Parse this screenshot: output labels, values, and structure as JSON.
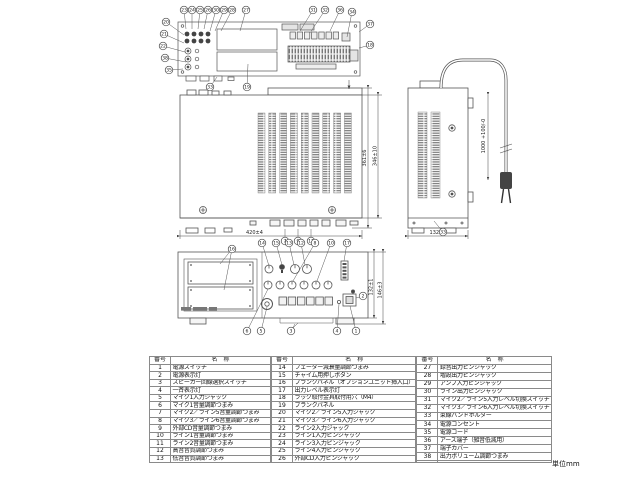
{
  "unit_label": "単位mm",
  "dims": {
    "top_width": "420±4",
    "depth_a": "361±6",
    "depth_b": "346±10",
    "side_width": "132±1",
    "cord_length": "1000 +100/-0",
    "front_height_a": "132±1",
    "front_height_b": "146±3"
  },
  "callouts": [
    {
      "n": "23",
      "x": 184,
      "y": 10,
      "lx": 186,
      "ly": 29
    },
    {
      "n": "24",
      "x": 192,
      "y": 10,
      "lx": 192,
      "ly": 29
    },
    {
      "n": "25",
      "x": 200,
      "y": 10,
      "lx": 198,
      "ly": 29
    },
    {
      "n": "26",
      "x": 208,
      "y": 10,
      "lx": 204,
      "ly": 29
    },
    {
      "n": "30",
      "x": 216,
      "y": 10,
      "lx": 210,
      "ly": 31
    },
    {
      "n": "29",
      "x": 224,
      "y": 10,
      "lx": 215,
      "ly": 31
    },
    {
      "n": "28",
      "x": 232,
      "y": 10,
      "lx": 221,
      "ly": 31
    },
    {
      "n": "27",
      "x": 246,
      "y": 10,
      "lx": 240,
      "ly": 31
    },
    {
      "n": "31",
      "x": 313,
      "y": 10,
      "lx": 300,
      "ly": 31
    },
    {
      "n": "32",
      "x": 325,
      "y": 10,
      "lx": 310,
      "ly": 33
    },
    {
      "n": "36",
      "x": 340,
      "y": 10,
      "lx": 330,
      "ly": 31
    },
    {
      "n": "34",
      "x": 352,
      "y": 12,
      "lx": 347,
      "ly": 37
    },
    {
      "n": "37",
      "x": 370,
      "y": 24,
      "lx": 359,
      "ly": 32
    },
    {
      "n": "18",
      "x": 370,
      "y": 45,
      "lx": 359,
      "ly": 48
    },
    {
      "n": "20",
      "x": 166,
      "y": 22,
      "lx": 184,
      "ly": 35
    },
    {
      "n": "21",
      "x": 164,
      "y": 34,
      "lx": 184,
      "ly": 43
    },
    {
      "n": "22",
      "x": 163,
      "y": 46,
      "lx": 185,
      "ly": 52
    },
    {
      "n": "38",
      "x": 165,
      "y": 58,
      "lx": 186,
      "ly": 62
    },
    {
      "n": "35",
      "x": 169,
      "y": 70,
      "lx": 183,
      "ly": 69
    },
    {
      "n": "33",
      "x": 210,
      "y": 87,
      "lx": 217,
      "ly": 77
    },
    {
      "n": "19",
      "x": 247,
      "y": 87,
      "lx": 248,
      "ly": 64
    },
    {
      "n": "7",
      "x": 285,
      "y": 241,
      "lx": 285,
      "ly": 229
    },
    {
      "n": "9",
      "x": 298,
      "y": 241,
      "lx": 298,
      "ly": 229
    },
    {
      "n": "11",
      "x": 311,
      "y": 241,
      "lx": 311,
      "ly": 229
    },
    {
      "n": "33",
      "x": 443,
      "y": 232,
      "lx": 434,
      "ly": 221
    },
    {
      "n": "14",
      "x": 262,
      "y": 243,
      "lx": 269,
      "ly": 266
    },
    {
      "n": "15",
      "x": 276,
      "y": 243,
      "lx": 282,
      "ly": 265
    },
    {
      "n": "13",
      "x": 289,
      "y": 243,
      "lx": 294,
      "ly": 265
    },
    {
      "n": "12",
      "x": 301,
      "y": 243,
      "lx": 305,
      "ly": 265
    },
    {
      "n": "8",
      "x": 315,
      "y": 243,
      "lx": 293,
      "ly": 281
    },
    {
      "n": "10",
      "x": 331,
      "y": 243,
      "lx": 317,
      "ly": 281
    },
    {
      "n": "17",
      "x": 347,
      "y": 243,
      "lx": 344,
      "ly": 261
    },
    {
      "n": "16",
      "x": 232,
      "y": 249,
      "lx": 220,
      "ly": 264,
      "lx2": 224,
      "ly2": 290
    },
    {
      "n": "6",
      "x": 247,
      "y": 331,
      "lx": 268,
      "ly": 289
    },
    {
      "n": "5",
      "x": 261,
      "y": 331,
      "lx": 267,
      "ly": 307
    },
    {
      "n": "3",
      "x": 291,
      "y": 331,
      "lx": 295,
      "ly": 324
    },
    {
      "n": "4",
      "x": 337,
      "y": 331,
      "lx": 339,
      "ly": 304
    },
    {
      "n": "1",
      "x": 356,
      "y": 331,
      "lx": 350,
      "ly": 306
    },
    {
      "n": "2",
      "x": 363,
      "y": 296,
      "lx": 356,
      "ly": 298
    }
  ],
  "table": {
    "header_no": "番号",
    "header_name": "名　称",
    "groups": [
      [
        {
          "no": "1",
          "name": "電源スイッチ"
        },
        {
          "no": "2",
          "name": "電源表示灯"
        },
        {
          "no": "3",
          "name": "スピーカー回線選択スイッチ"
        },
        {
          "no": "4",
          "name": "一斉表示灯"
        },
        {
          "no": "5",
          "name": "マイク1入力ジャック"
        },
        {
          "no": "6",
          "name": "マイク1音量調節つまみ"
        },
        {
          "no": "7",
          "name": "マイク2／ライン5音量調節つまみ"
        },
        {
          "no": "8",
          "name": "マイク3／ライン6音量調節つまみ"
        },
        {
          "no": "9",
          "name": "外部CD音量調節つまみ"
        },
        {
          "no": "10",
          "name": "ライン1音量調節つまみ"
        },
        {
          "no": "11",
          "name": "ライン2音量調節つまみ"
        },
        {
          "no": "12",
          "name": "高音音質調節つまみ"
        },
        {
          "no": "13",
          "name": "低音音質調節つまみ"
        }
      ],
      [
        {
          "no": "14",
          "name": "フェーダー減衰量調節つまみ"
        },
        {
          "no": "15",
          "name": "チャイム用押しボタン"
        },
        {
          "no": "16",
          "name": "ブランクパネル（オプションユニット挿入口）"
        },
        {
          "no": "17",
          "name": "出力レベル表示灯"
        },
        {
          "no": "18",
          "name": "ラック取付金具取付用穴（M4）"
        },
        {
          "no": "19",
          "name": "ブランクパネル"
        },
        {
          "no": "20",
          "name": "マイク2／ライン5入力ジャック"
        },
        {
          "no": "21",
          "name": "マイク3／ライン6入力ジャック"
        },
        {
          "no": "22",
          "name": "ライン2入力ジャック"
        },
        {
          "no": "23",
          "name": "ライン1入力ピンジャック"
        },
        {
          "no": "24",
          "name": "ライン3入力ピンジャック"
        },
        {
          "no": "25",
          "name": "ライン4入力ピンジャック"
        },
        {
          "no": "26",
          "name": "外部CD入力ピンジャック"
        }
      ],
      [
        {
          "no": "27",
          "name": "録音出力ピンジャック"
        },
        {
          "no": "28",
          "name": "増設出力ピンジャック"
        },
        {
          "no": "29",
          "name": "アンプ入力ピンジャック"
        },
        {
          "no": "30",
          "name": "ライン出力ピンジャック"
        },
        {
          "no": "31",
          "name": "マイク2／ライン5入力レベル切換スイッチ"
        },
        {
          "no": "32",
          "name": "マイク3／ライン6入力レベル切換スイッチ"
        },
        {
          "no": "33",
          "name": "束線バンドホルダー"
        },
        {
          "no": "34",
          "name": "電源コンセント"
        },
        {
          "no": "35",
          "name": "電源コード"
        },
        {
          "no": "36",
          "name": "アース端子（雑音低減用）"
        },
        {
          "no": "37",
          "name": "端子カバー"
        },
        {
          "no": "38",
          "name": "出力ボリューム調節つまみ"
        },
        {
          "no": "",
          "name": ""
        }
      ]
    ]
  }
}
